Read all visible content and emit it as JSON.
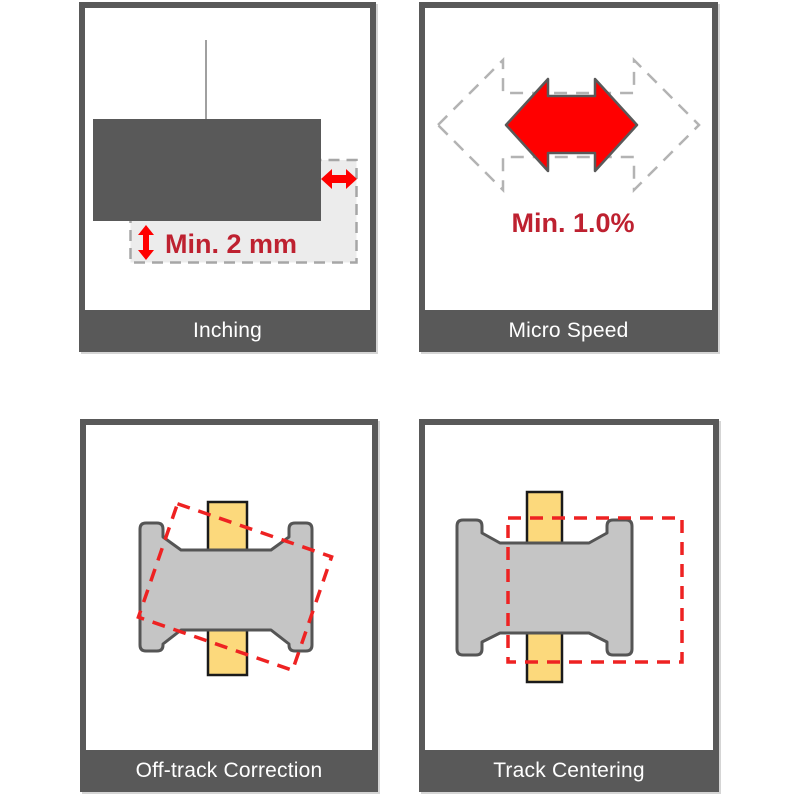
{
  "panels": [
    {
      "id": "inching",
      "label": "Inching",
      "annotation": "Min. 2 mm"
    },
    {
      "id": "micro-speed",
      "label": "Micro Speed",
      "annotation": "Min. 1.0%"
    },
    {
      "id": "off-track-correction",
      "label": "Off-track Correction",
      "annotation": ""
    },
    {
      "id": "track-centering",
      "label": "Track Centering",
      "annotation": ""
    }
  ],
  "colors": {
    "frame_gray": "#595959",
    "label_text": "#ffffff",
    "arrow_red": "#ff0000",
    "annotation_red": "#be2130",
    "dashed_outline_red": "#ee2222",
    "ghost_fill_gray": "#ececec",
    "ghost_dash_gray": "#a6a6a6",
    "speed_dash_gray": "#b3b3b3",
    "spool_fill_gray": "#c5c5c5",
    "spool_stroke": "#555555",
    "track_yellow": "#fcd97c",
    "track_stroke": "#1a1a1a",
    "hanger_line_gray": "#808080"
  },
  "icons": {
    "min-gap-arrow-icon": "↔ solid red horizontal double arrow",
    "min-lift-arrow-icon": "↕ solid red vertical double arrow",
    "speed-range-arrow-icon": "⬌ dashed gray outline double arrow",
    "speed-min-arrow-icon": "⬌ solid red double arrow with gray outline"
  }
}
